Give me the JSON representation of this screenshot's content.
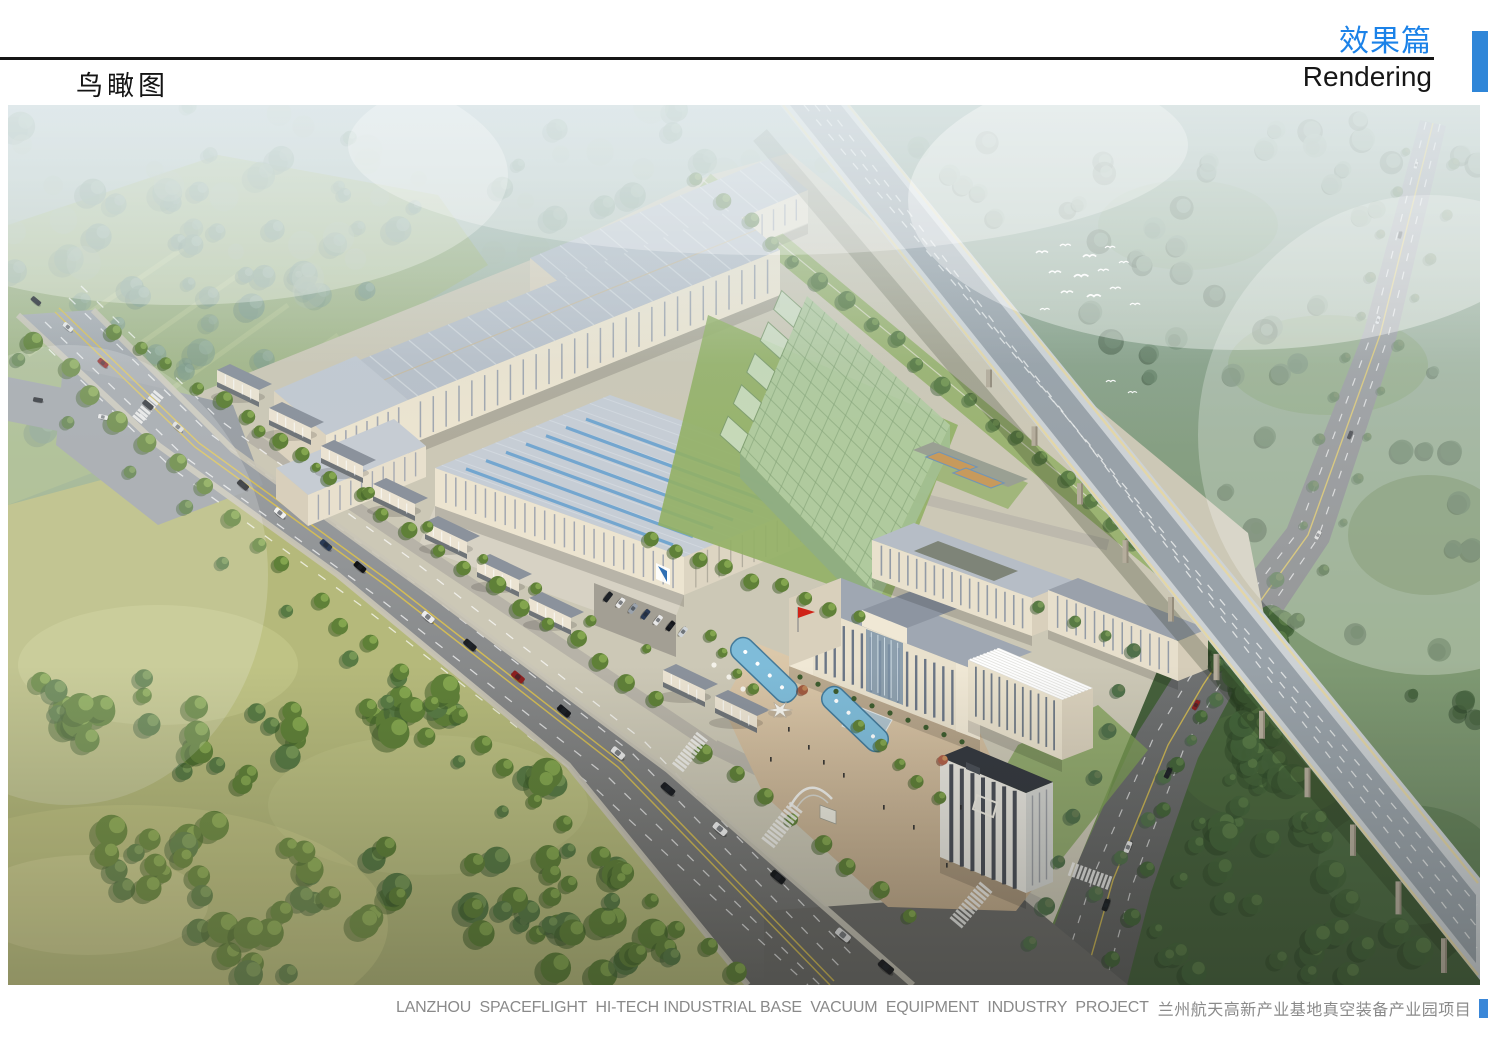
{
  "page": {
    "background": "#ffffff",
    "width": 1488,
    "height": 1052
  },
  "header": {
    "section_title_zh": "效果篇",
    "section_title_en": "Rendering",
    "page_title_zh": "鸟瞰图"
  },
  "caption": {
    "en": "LANZHOU  SPACEFLIGHT  HI-TECH INDUSTRIAL BASE  VACUUM  EQUIPMENT  INDUSTRY  PROJECT",
    "zh": "兰州航天高新产业基地真空装备产业园项目"
  },
  "palette": {
    "accent_blue": "#1b82e8",
    "corner_tab_blue": "#2f86d8",
    "caption_square_blue": "#3a87d8",
    "caption_gray": "#8a8a8a",
    "rule_black": "#151515"
  },
  "figure": {
    "kind": "aerial-architectural-rendering",
    "palette": {
      "sky_haze": "#c7d8de",
      "field": "#b5b97b",
      "forest": "#4d6c33",
      "road": "#9aa0a6",
      "building_wall": "#ece4d0",
      "factory_roof": "#b9c0c9",
      "glass_building": "#b2cba1",
      "pool": "#84bfdd",
      "flag": "#cf2318",
      "viaduct_deck": "#cdd2d5"
    }
  }
}
